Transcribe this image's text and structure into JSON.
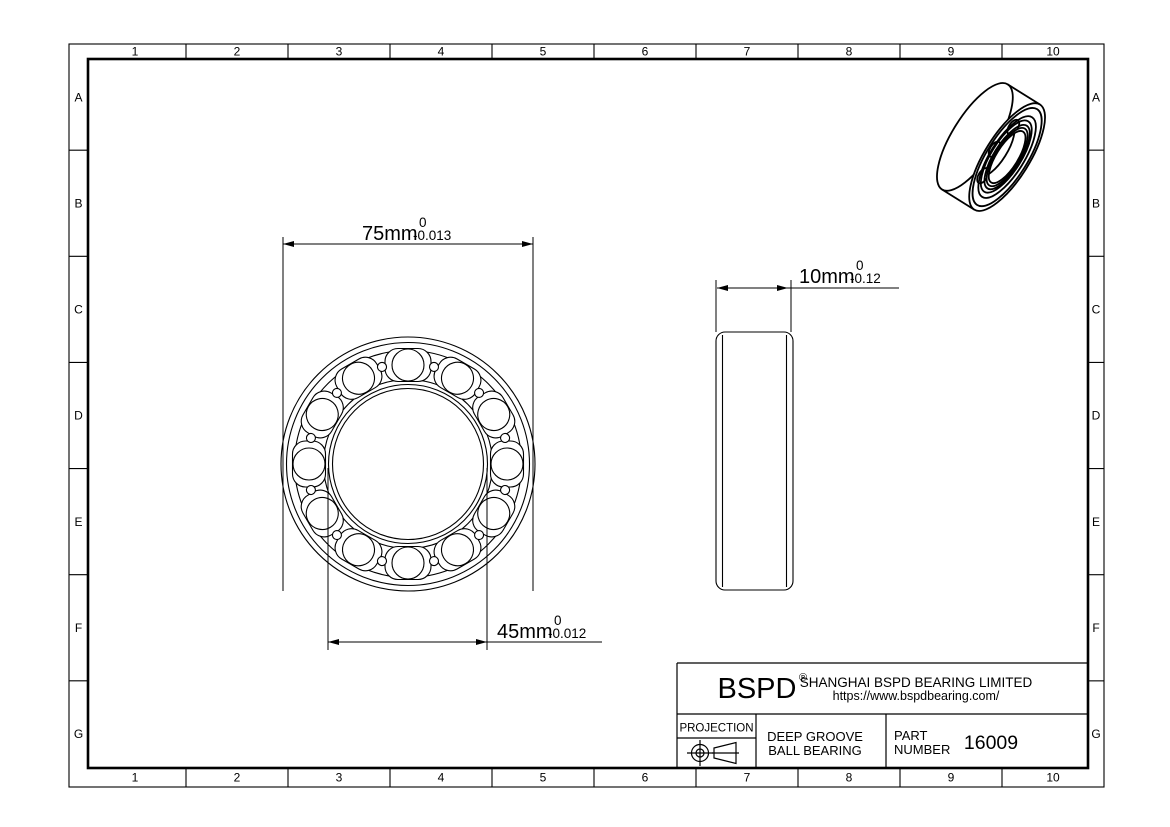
{
  "page": {
    "background": "#ffffff",
    "line_color": "#000000"
  },
  "grid": {
    "columns": [
      "1",
      "2",
      "3",
      "4",
      "5",
      "6",
      "7",
      "8",
      "9",
      "10"
    ],
    "rows": [
      "A",
      "B",
      "C",
      "D",
      "E",
      "F",
      "G"
    ]
  },
  "dimensions": {
    "outer_diameter": {
      "value": "75mm",
      "tolerance_upper": "0",
      "tolerance_lower": "-0.013"
    },
    "bore_diameter": {
      "value": "45mm",
      "tolerance_upper": "0",
      "tolerance_lower": "-0.012"
    },
    "width": {
      "value": "10mm",
      "tolerance_upper": "0",
      "tolerance_lower": "-0.12"
    }
  },
  "title_block": {
    "logo": "BSPD",
    "registered_mark": "®",
    "company_name": "SHANGHAI BSPD BEARING LIMITED",
    "website": "https://www.bspdbearing.com/",
    "projection_label": "PROJECTION",
    "product_type_line1": "DEEP GROOVE",
    "product_type_line2": "BALL BEARING",
    "part_label_line1": "PART",
    "part_label_line2": "NUMBER",
    "part_number": "16009"
  }
}
